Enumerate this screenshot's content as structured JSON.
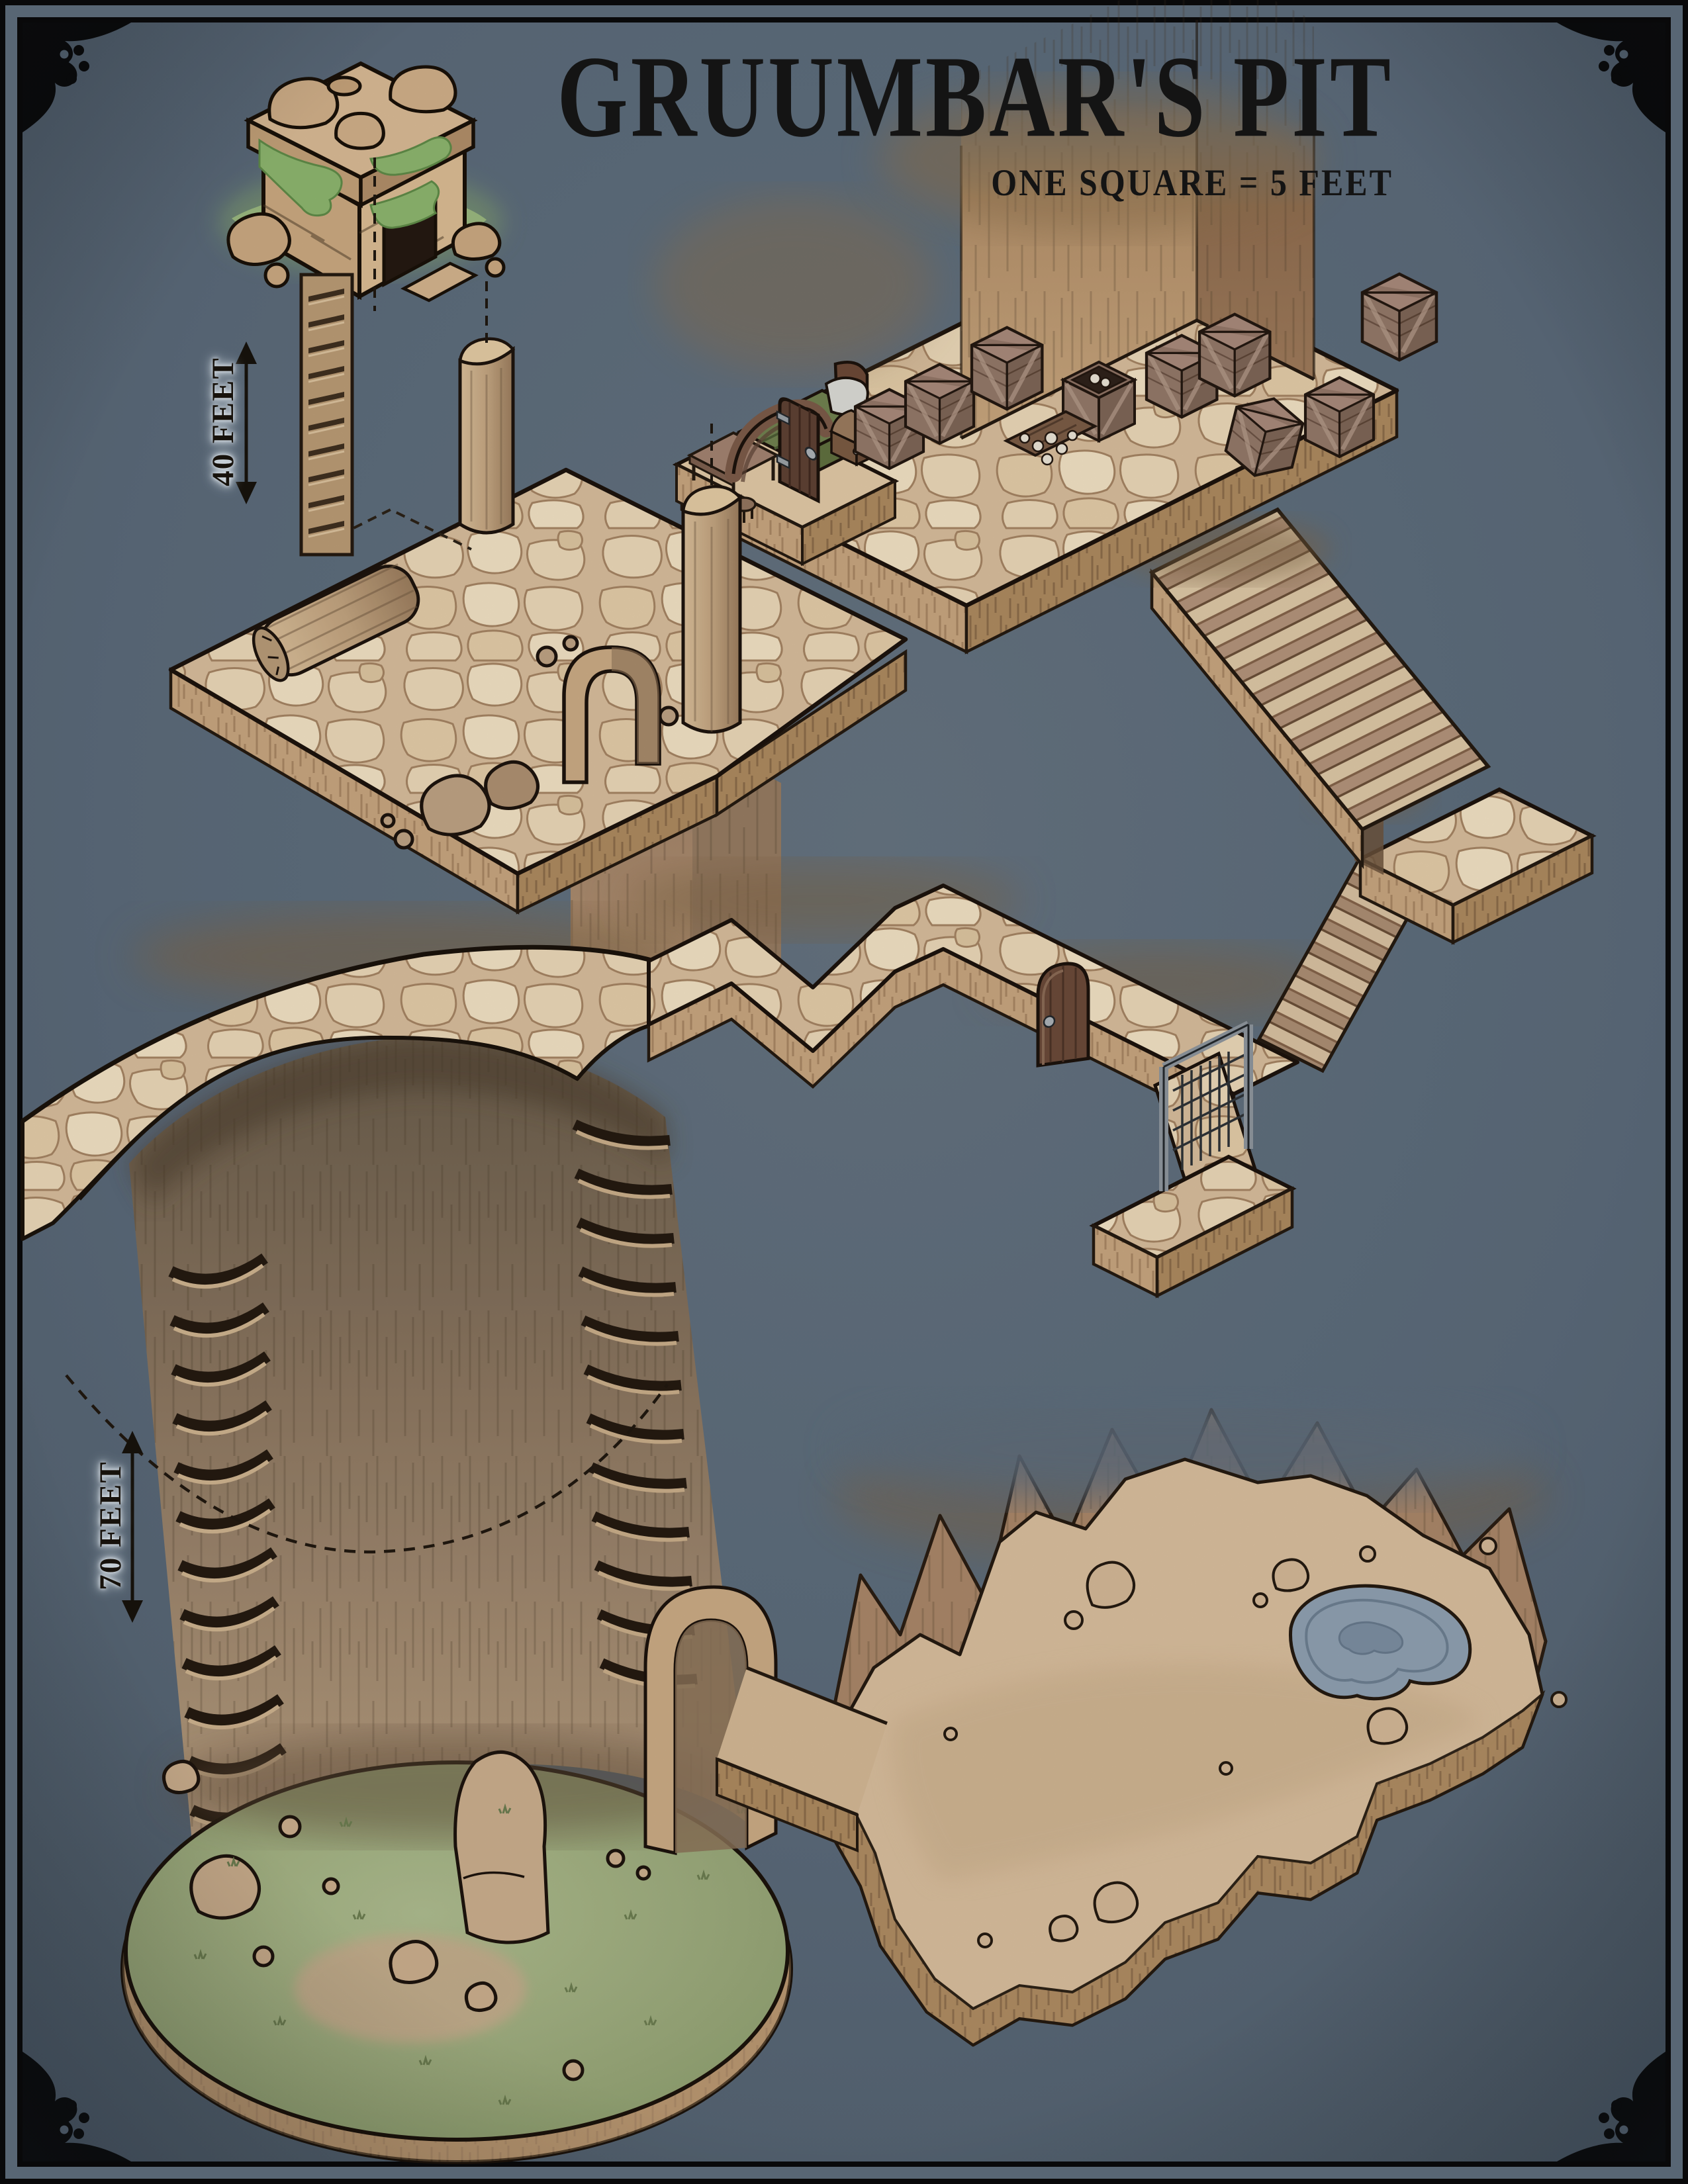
{
  "header": {
    "title": "GRUUMBAR'S PIT",
    "subtitle": "ONE SQUARE = 5 FEET"
  },
  "scale_markers": {
    "upper": "40 FEET",
    "lower": "70 FEET"
  },
  "colors": {
    "background": "#5d6c7c",
    "frame_band": "#5e6c7b",
    "frame_ink": "#0a0a0b",
    "stone_light": "#e9d6b6",
    "stone_joint": "#a58463",
    "earth_side": "#c6a57e",
    "pit_wall": "#9a8164",
    "moss": "#8cb46e",
    "grass_floor": "#9cab7c",
    "water": "#8e9fb0",
    "ink": "#1c130c",
    "label_ink": "#17120c",
    "halo": "#e6edf3"
  }
}
